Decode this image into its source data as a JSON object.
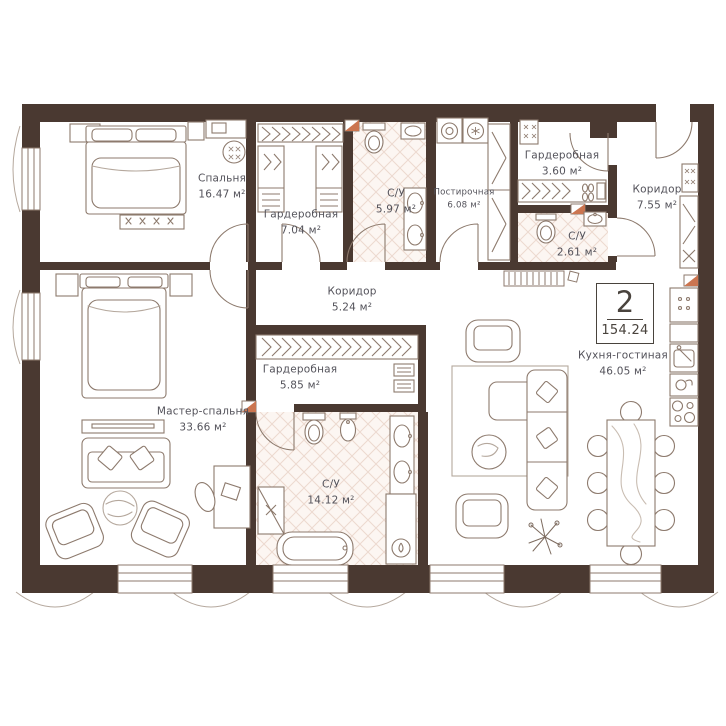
{
  "plan": {
    "badge": {
      "rooms_count": "2",
      "total_area": "154.24"
    },
    "rooms": [
      {
        "id": "bedroom",
        "label": "Спальня",
        "area": "16.47 м²"
      },
      {
        "id": "wardrobe-1",
        "label": "Гардеробная",
        "area": "7.04 м²"
      },
      {
        "id": "bathroom-1",
        "label": "С/У",
        "area": "5.97 м²"
      },
      {
        "id": "laundry",
        "label": "Постирочная",
        "area": "6.08 м²"
      },
      {
        "id": "wardrobe-2",
        "label": "Гардеробная",
        "area": "3.60 м²"
      },
      {
        "id": "corridor-1",
        "label": "Коридор",
        "area": "7.55 м²"
      },
      {
        "id": "bathroom-2",
        "label": "С/У",
        "area": "2.61 м²"
      },
      {
        "id": "corridor-2",
        "label": "Коридор",
        "area": "5.24 м²"
      },
      {
        "id": "wardrobe-3",
        "label": "Гардеробная",
        "area": "5.85 м²"
      },
      {
        "id": "master-bedroom",
        "label": "Мастер-спальня",
        "area": "33.66 м²"
      },
      {
        "id": "bathroom-3",
        "label": "С/У",
        "area": "14.12 м²"
      },
      {
        "id": "kitchen-living",
        "label": "Кухня-гостиная",
        "area": "46.05 м²"
      }
    ],
    "colors": {
      "wall": "#4a3931",
      "furniture_line": "#8d7a6d",
      "light_line": "#b5a89d",
      "bath_floor": "#fcf6f2",
      "bath_lattice": "#ecd9cf",
      "vent_accent": "#cb7550",
      "label_text": "#53525a"
    }
  }
}
